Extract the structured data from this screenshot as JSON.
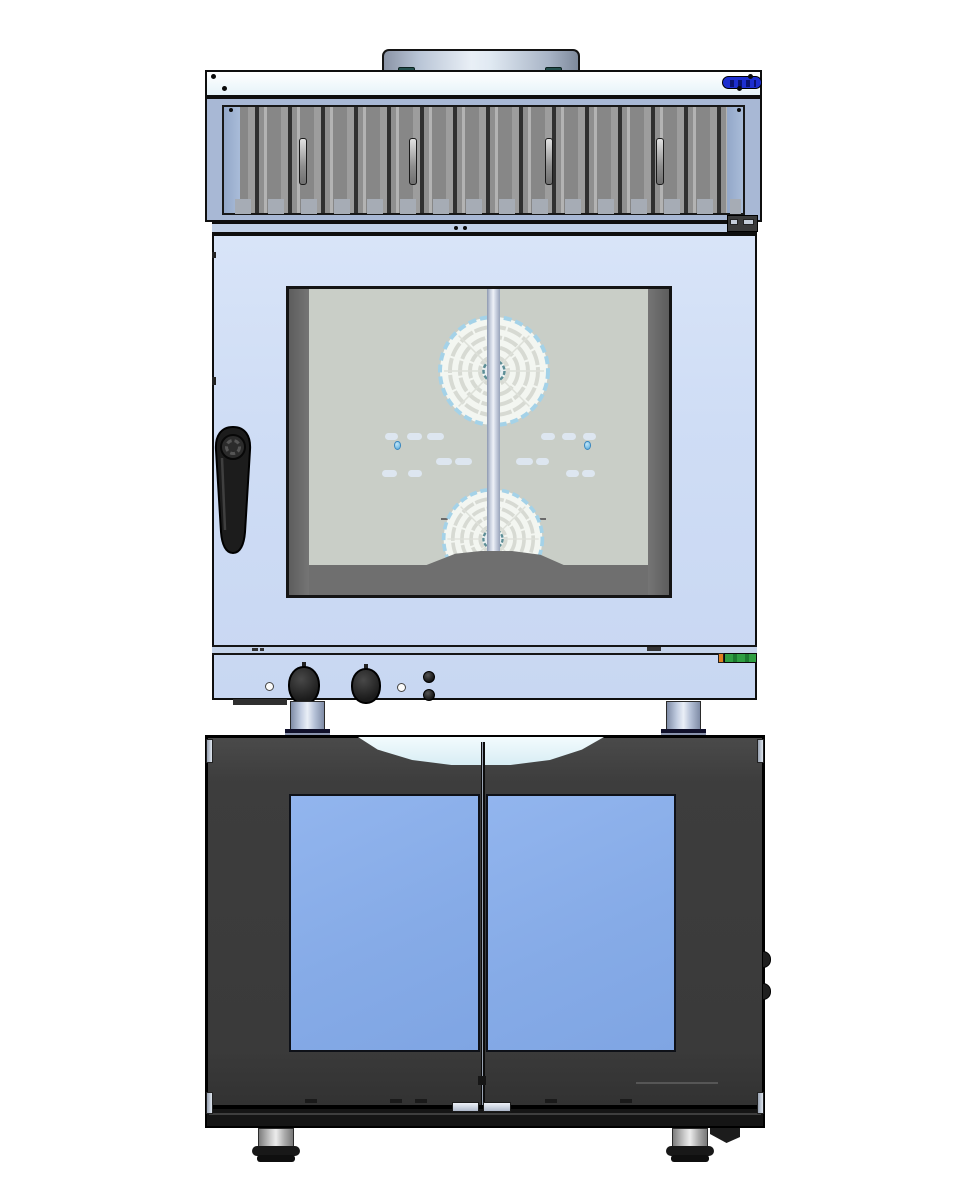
{
  "machine": {
    "type": "combi-steam-oven-on-base-cabinet",
    "view": "front-elevation-cad-render",
    "visible_text": "",
    "labels": {
      "hood_badge": "illegible-blue-brand-badge",
      "control_sticker": "illegible-green-rating-label"
    }
  },
  "palette": {
    "panel_white": "#e6f3f9",
    "steel_frame": "#a8b8d5",
    "slat_gray": "#878787",
    "badge_blue": "#1d2fd0",
    "oven_face": "#cfddf5",
    "interior_gray": "#c9cec7",
    "frame_gray": "#6f6f6f",
    "fan_ring_blue": "#a4d2e8",
    "glass_blue": "#86abe7",
    "cabinet_dark": "#3d3d3d",
    "recess_pale": "#f2fbfd",
    "sticker_green": "#2f9e42",
    "sticker_orange": "#e08020",
    "leg_steel": "#c2cde1",
    "handle_black": "#1c1c1c"
  },
  "geometry": {
    "screws": [
      {
        "x": 211,
        "y": 74,
        "d": 5
      },
      {
        "x": 222,
        "y": 86,
        "d": 5
      },
      {
        "x": 748,
        "y": 74,
        "d": 5
      },
      {
        "x": 737,
        "y": 86,
        "d": 5
      },
      {
        "x": 229,
        "y": 108,
        "d": 4
      },
      {
        "x": 737,
        "y": 108,
        "d": 4
      },
      {
        "x": 454,
        "y": 226,
        "d": 4
      },
      {
        "x": 463,
        "y": 226,
        "d": 4
      }
    ],
    "hood_handles": [
      {
        "x": 299,
        "y": 138
      },
      {
        "x": 409,
        "y": 138
      },
      {
        "x": 545,
        "y": 138
      },
      {
        "x": 656,
        "y": 138
      }
    ],
    "pills": [
      {
        "x": 385,
        "y": 433,
        "w": 13,
        "h": 7
      },
      {
        "x": 407,
        "y": 433,
        "w": 15,
        "h": 7
      },
      {
        "x": 427,
        "y": 433,
        "w": 17,
        "h": 7
      },
      {
        "x": 541,
        "y": 433,
        "w": 14,
        "h": 7
      },
      {
        "x": 562,
        "y": 433,
        "w": 14,
        "h": 7
      },
      {
        "x": 583,
        "y": 433,
        "w": 13,
        "h": 7
      },
      {
        "x": 436,
        "y": 458,
        "w": 16,
        "h": 7
      },
      {
        "x": 455,
        "y": 458,
        "w": 17,
        "h": 7
      },
      {
        "x": 516,
        "y": 458,
        "w": 17,
        "h": 7
      },
      {
        "x": 536,
        "y": 458,
        "w": 13,
        "h": 7
      },
      {
        "x": 382,
        "y": 470,
        "w": 15,
        "h": 7
      },
      {
        "x": 408,
        "y": 470,
        "w": 14,
        "h": 7
      },
      {
        "x": 566,
        "y": 470,
        "w": 13,
        "h": 7
      },
      {
        "x": 582,
        "y": 470,
        "w": 13,
        "h": 7
      }
    ],
    "droplets": [
      {
        "x": 394,
        "y": 441
      },
      {
        "x": 584,
        "y": 441
      }
    ],
    "cab_slivers": [
      {
        "x": 206,
        "y": 739,
        "h": 24
      },
      {
        "x": 757,
        "y": 739,
        "h": 24
      },
      {
        "x": 206,
        "y": 1092,
        "h": 22
      },
      {
        "x": 757,
        "y": 1092,
        "h": 22
      }
    ],
    "cab_bumps": [
      {
        "x": 762,
        "y": 951
      },
      {
        "x": 762,
        "y": 983
      }
    ],
    "door_dashes": [
      {
        "x": 305,
        "y": 1099
      },
      {
        "x": 390,
        "y": 1099
      },
      {
        "x": 415,
        "y": 1099
      },
      {
        "x": 545,
        "y": 1099
      },
      {
        "x": 620,
        "y": 1099
      }
    ]
  }
}
